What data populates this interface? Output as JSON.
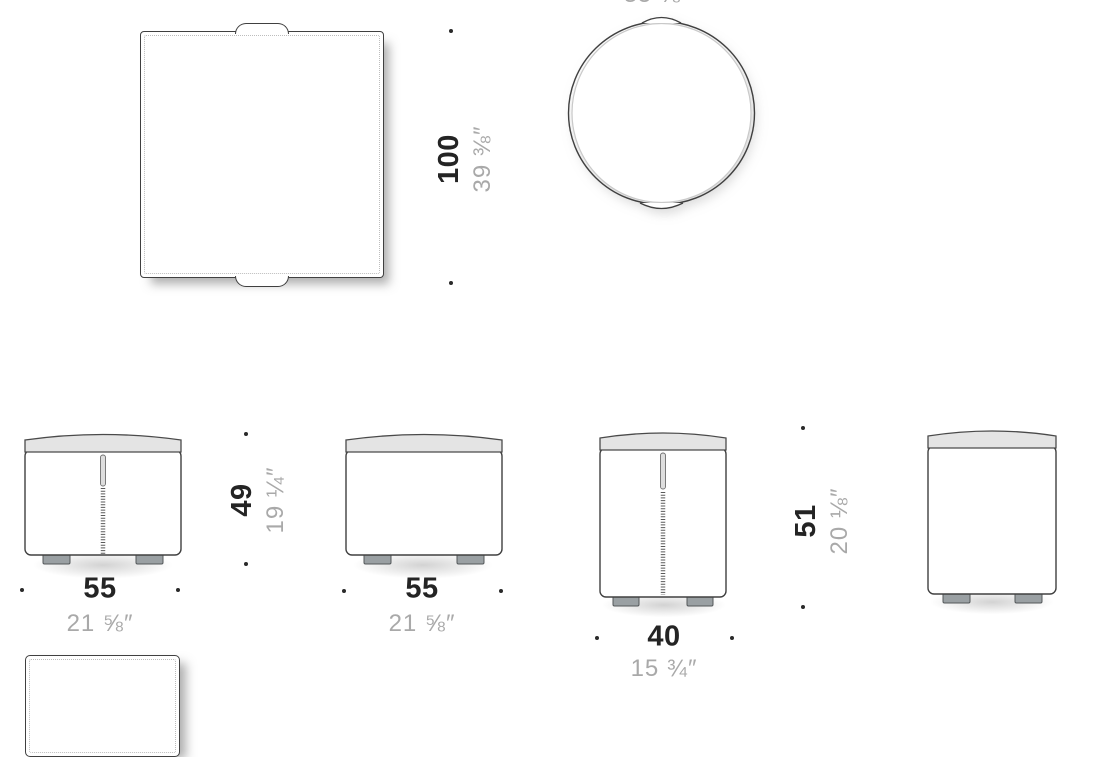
{
  "colors": {
    "outline": "#404040",
    "stitch": "#bdbdbd",
    "band_fill": "#e4e4e4",
    "foot_fill": "#9aa0a3",
    "cm_text": "#242424",
    "inch_text": "#a9a9a9"
  },
  "top_row": {
    "square": {
      "height_cm": "100",
      "height_in": "39 ⅜″"
    },
    "circle": {
      "clipped_in": "35 ⅜″"
    }
  },
  "bottom_row": {
    "pouf_front_small": {
      "width_cm": "55",
      "width_in": "21 ⅝″",
      "height_cm": "49",
      "height_in": "19 ¼″"
    },
    "pouf_side_small": {
      "width_cm": "55",
      "width_in": "21 ⅝″"
    },
    "pouf_front_tall": {
      "width_cm": "40",
      "width_in": "15 ¾″",
      "height_cm": "51",
      "height_in": "20 ⅛″"
    }
  }
}
